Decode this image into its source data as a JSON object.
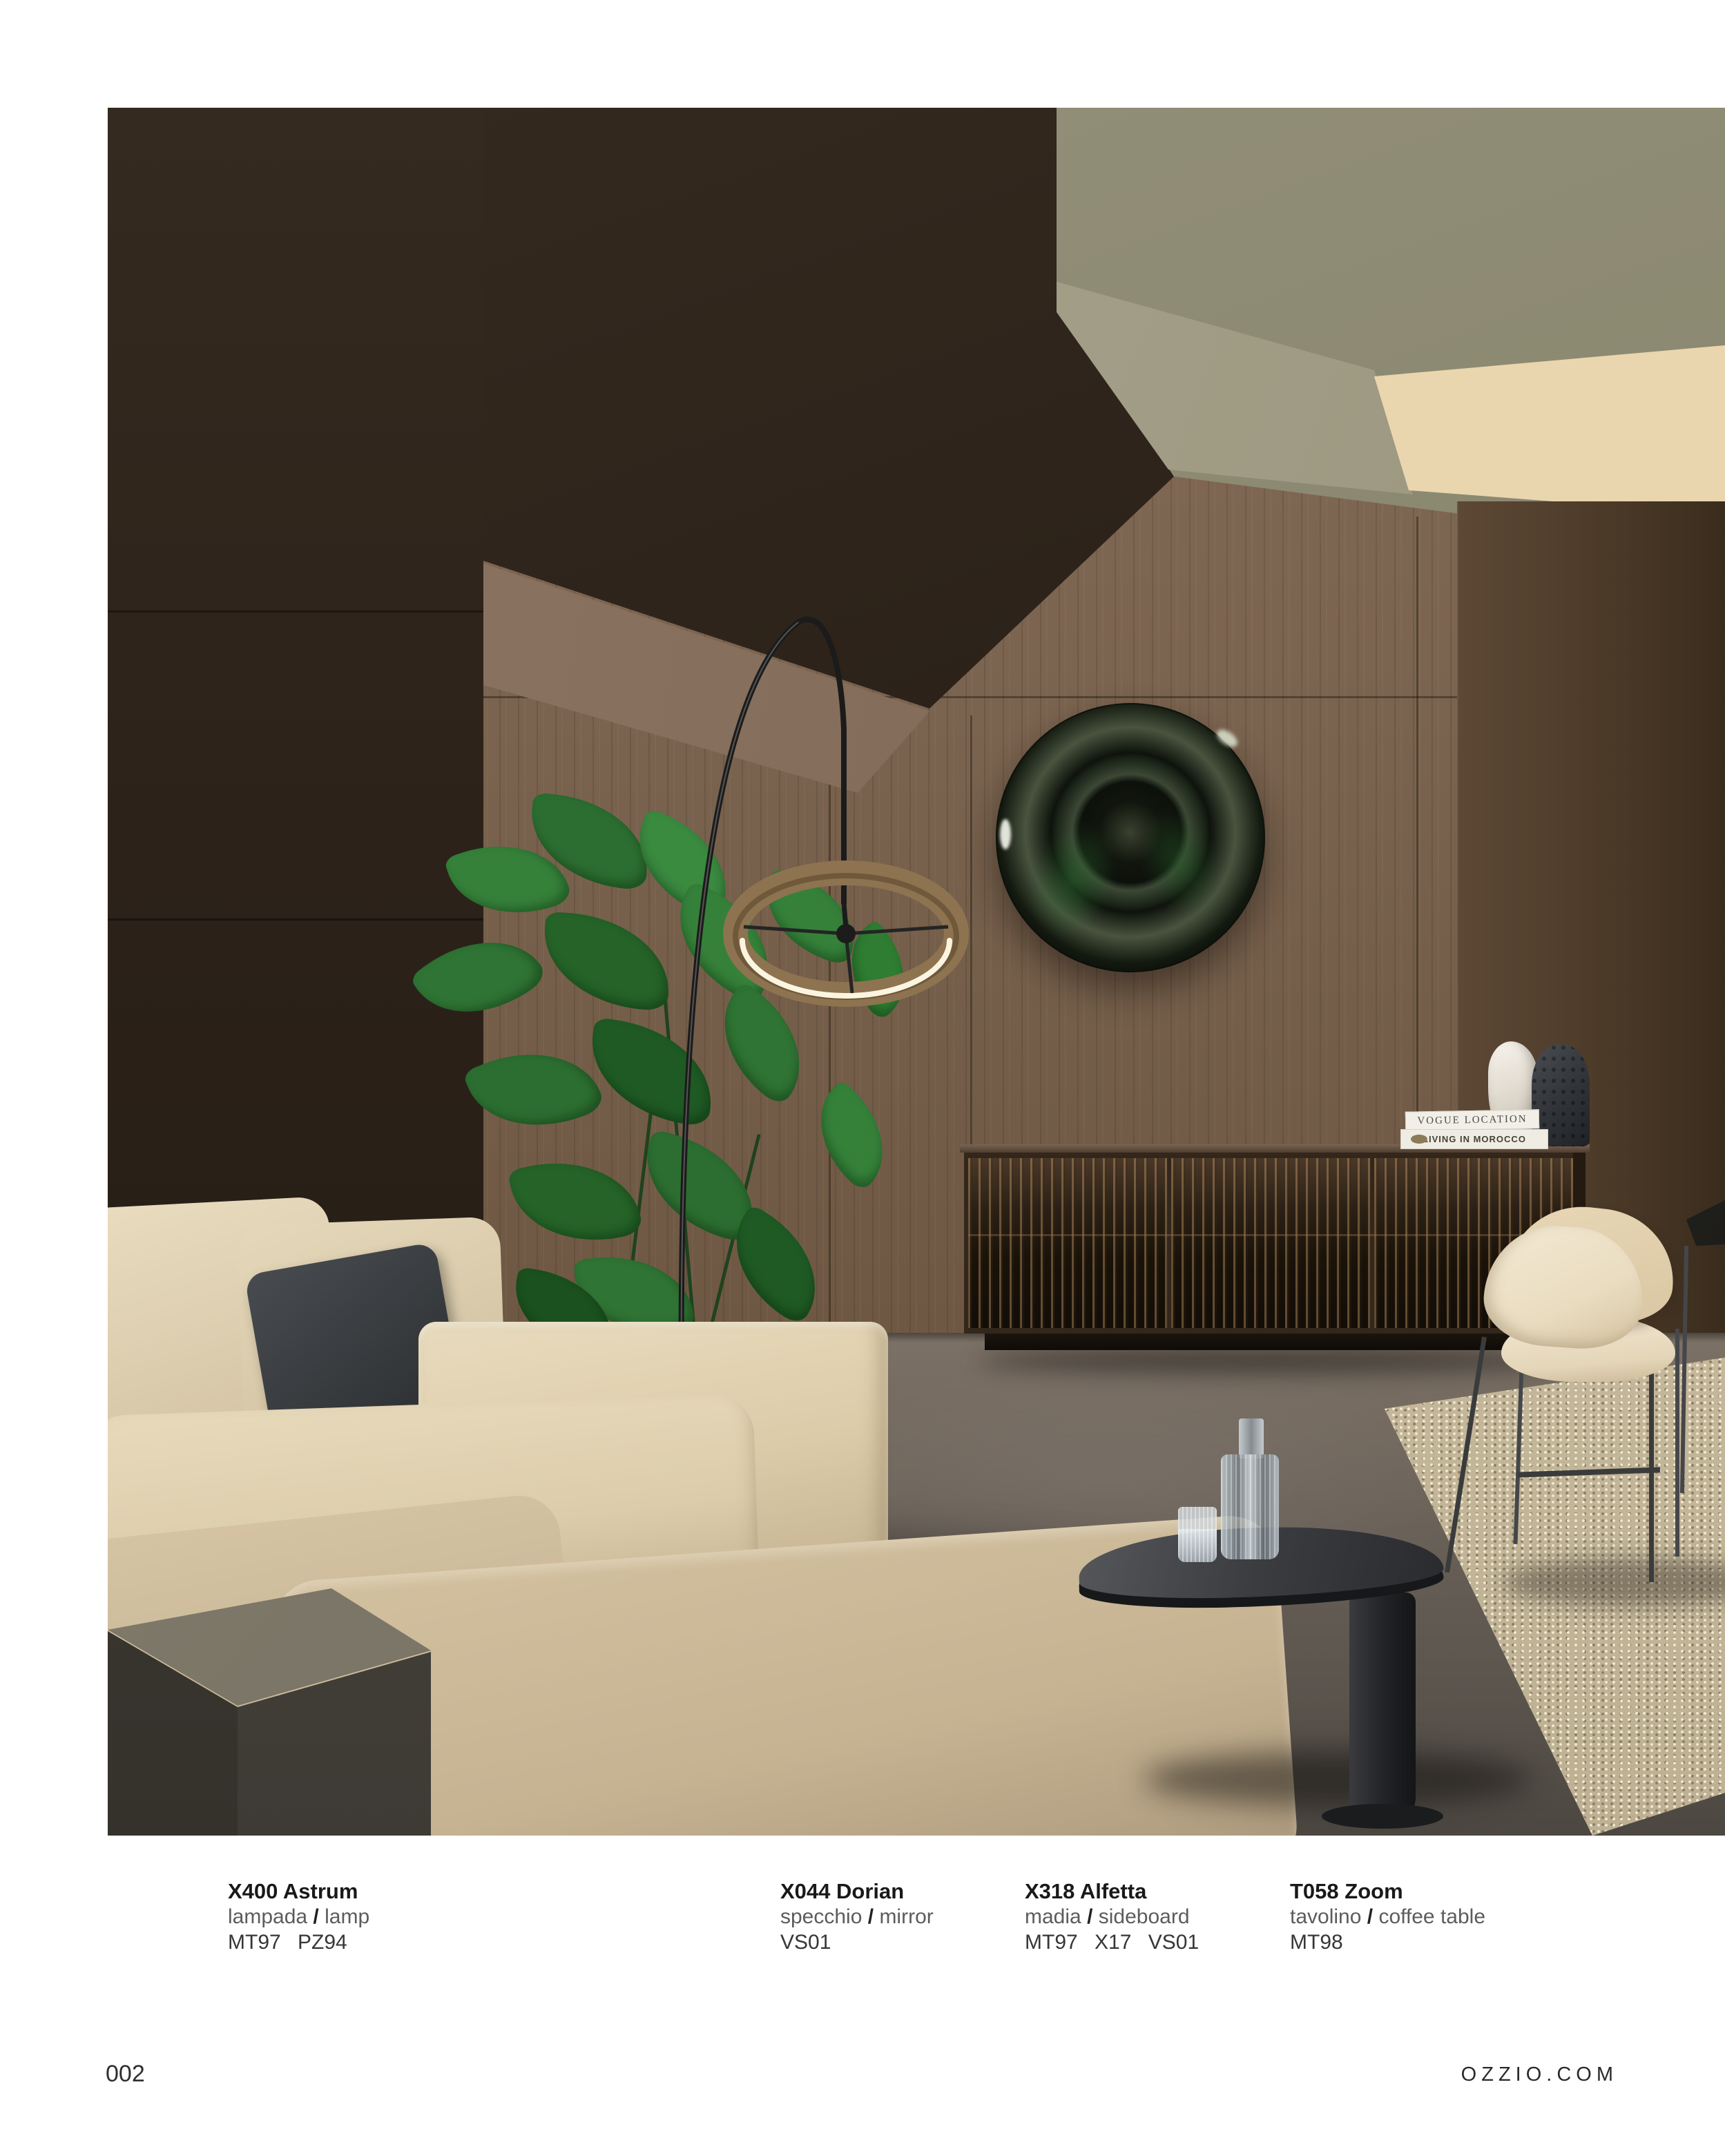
{
  "page": {
    "number": "002",
    "website": "OZZIO.COM"
  },
  "slash": "/",
  "captions": [
    {
      "name": "X400 Astrum",
      "type_it": "lampada",
      "type_en": "lamp",
      "codes": "MT97 PZ94"
    },
    {
      "name": "X044 Dorian",
      "type_it": "specchio",
      "type_en": "mirror",
      "codes": "VS01"
    },
    {
      "name": "X318 Alfetta",
      "type_it": "madia",
      "type_en": "sideboard",
      "codes": "MT97 X17 VS01"
    },
    {
      "name": "T058 Zoom",
      "type_it": "tavolino",
      "type_en": "coffee table",
      "codes": "MT98"
    }
  ],
  "photo": {
    "books": [
      {
        "spine": "VOGUE LOCATION"
      },
      {
        "spine": "LIVING IN MOROCCO"
      }
    ]
  },
  "colors": {
    "wall_wood": "#7b6450",
    "wall_dark": "#2f251c",
    "ceiling_olive": "#8f8c76",
    "skylight_cream": "#eedcb8",
    "sofa_cream": "#e2d4b5",
    "floor_gray": "#665e56",
    "mirror_green": "#2e3a2a"
  }
}
